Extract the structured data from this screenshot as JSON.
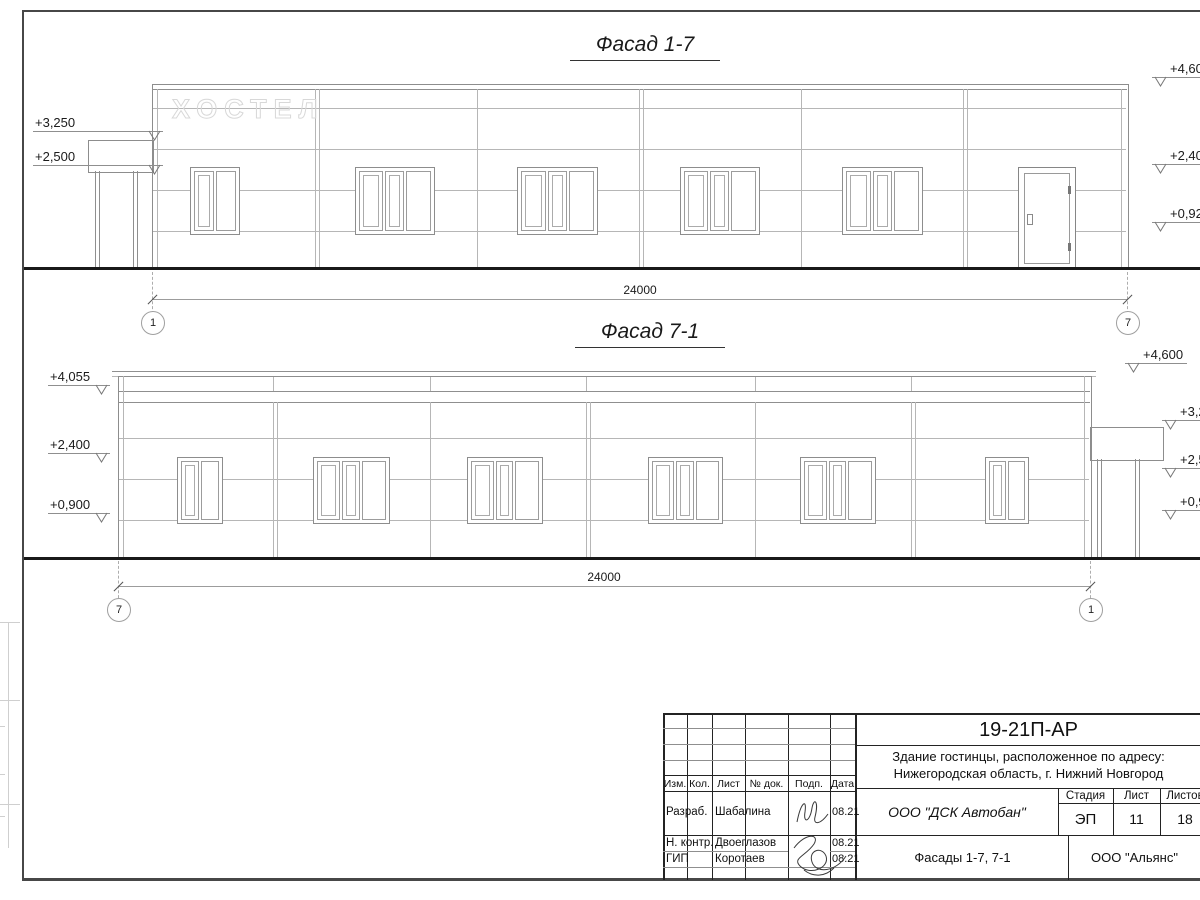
{
  "facade1": {
    "title": "Фасад 1-7",
    "signage": "ХОСТЕЛ",
    "dimension": "24000",
    "axis_left": "1",
    "axis_right": "7",
    "marks_left": [
      "+3,250",
      "+2,500"
    ],
    "marks_right": [
      "+4,600",
      "+2,400",
      "+0,920"
    ]
  },
  "facade2": {
    "title": "Фасад 7-1",
    "dimension": "24000",
    "axis_left": "7",
    "axis_right": "1",
    "marks_left": [
      "+4,055",
      "+2,400",
      "+0,900"
    ],
    "marks_right": [
      "+4,600",
      "+3,250",
      "+2,500",
      "+0,920"
    ]
  },
  "titleblock": {
    "doc_number": "19-21П-АР",
    "desc_line1": "Здание гостинцы, расположенное по адресу:",
    "desc_line2": "Нижегородская область, г. Нижний Новгород",
    "header_cols": [
      "Изм.",
      "Кол.",
      "Лист",
      "№ док.",
      "Подп.",
      "Дата"
    ],
    "rows": [
      {
        "role": "Разраб.",
        "name": "Шабалина",
        "date": "08.21"
      },
      {
        "role": "Н. контр.",
        "name": "Двоеглазов",
        "date": "08.21"
      },
      {
        "role": "ГИП",
        "name": "Коротаев",
        "date": "08.21"
      }
    ],
    "company": "ООО \"ДСК Автобан\"",
    "stage_label": "Стадия",
    "sheet_label": "Лист",
    "sheets_label": "Листов",
    "stage": "ЭП",
    "sheet_num": "11",
    "sheets_total": "18",
    "drawing_title": "Фасады 1-7, 7-1",
    "contractor": "ООО \"Альянс\""
  },
  "colors": {
    "line_thin": "#b6b6b6",
    "line_dark": "#2b2b2b",
    "ground": "#191919"
  }
}
